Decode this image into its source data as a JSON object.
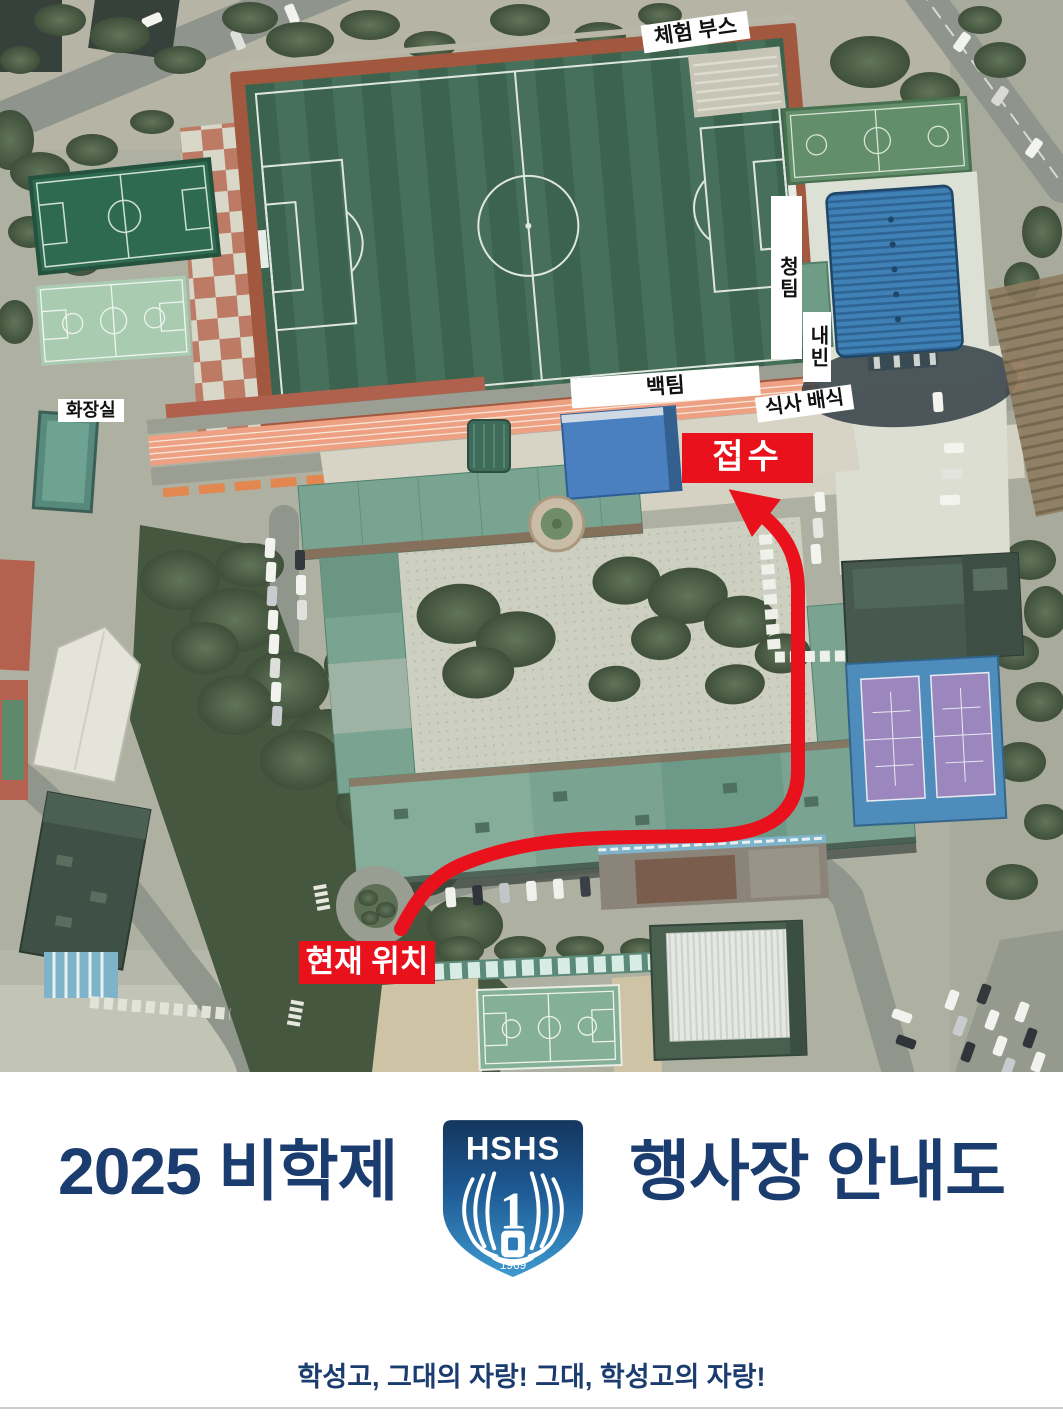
{
  "poster": {
    "map_labels": {
      "experience_booth": "체험 부스",
      "blue_team": "청팀",
      "guests": "내빈",
      "white_team": "백팀",
      "meal_service": "식사 배식",
      "reception": "접수",
      "current_location": "현재 위치",
      "restroom": "화장실"
    },
    "footer": {
      "title_left": "2025 비학제",
      "title_right": "행사장 안내도",
      "slogan": "학성고, 그대의 자랑!  그대, 학성고의 자랑!"
    },
    "logo": {
      "school_acronym": "HSHS",
      "rank_number": "1",
      "founding_year": "1969"
    },
    "colors": {
      "route_red": "#e8111c",
      "title_navy": "#1b3c6e",
      "logo_gradient_top": "#14365e",
      "logo_gradient_bottom": "#3e9ad0"
    }
  }
}
